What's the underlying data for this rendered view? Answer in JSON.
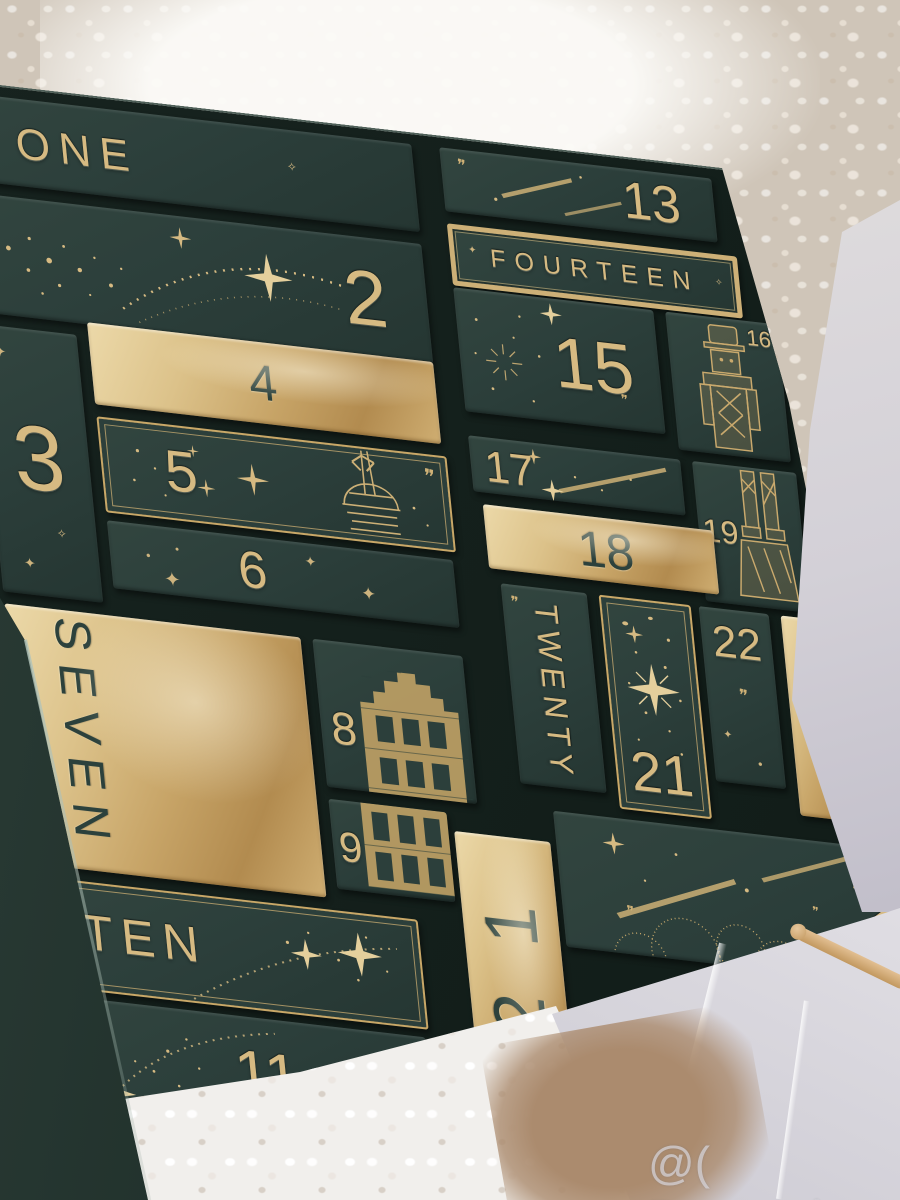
{
  "scene": {
    "description": "Dark green and gold beauty advent calendar with 24 numbered drawer boxes, photographed at an angle on cream boucle fabric",
    "watermark": "@( Bazos.sk"
  },
  "palette": {
    "box_dark": "#2c3f3b",
    "tray_dark": "#14201c",
    "gold_foil": "#d6ba82",
    "gold_bright": "#ecd9a9",
    "ink_on_gold": "#2c413c",
    "fabric_beige": "#cfc5b8",
    "fabric_white": "#f1efec",
    "curtain_grey": "#d3d0d7",
    "fur_tan": "#ab8b6e",
    "wood": "#d2a878"
  },
  "calendar": {
    "boxes": [
      {
        "num": 1,
        "label": "ONE",
        "finish": "dark"
      },
      {
        "num": 2,
        "label": "2",
        "finish": "dark"
      },
      {
        "num": 3,
        "label": "3",
        "finish": "dark"
      },
      {
        "num": 4,
        "label": "4",
        "finish": "gold"
      },
      {
        "num": 5,
        "label": "5",
        "finish": "dark-gold-frame"
      },
      {
        "num": 6,
        "label": "6",
        "finish": "dark"
      },
      {
        "num": 7,
        "label": "SEVEN",
        "finish": "gold"
      },
      {
        "num": 8,
        "label": "8",
        "finish": "dark"
      },
      {
        "num": 9,
        "label": "9",
        "finish": "dark"
      },
      {
        "num": 10,
        "label": "TEN",
        "finish": "dark-gold-frame"
      },
      {
        "num": 11,
        "label": "11",
        "finish": "dark"
      },
      {
        "num": 12,
        "label": "12",
        "digits": [
          "1",
          "2"
        ],
        "finish": "gold"
      },
      {
        "num": 13,
        "label": "13",
        "finish": "dark"
      },
      {
        "num": 14,
        "label": "FOURTEEN",
        "finish": "dark-gold-banner"
      },
      {
        "num": 15,
        "label": "15",
        "finish": "dark"
      },
      {
        "num": 16,
        "label": "16",
        "finish": "dark"
      },
      {
        "num": 17,
        "label": "17",
        "finish": "dark"
      },
      {
        "num": 18,
        "label": "18",
        "finish": "gold"
      },
      {
        "num": 19,
        "label": "19",
        "finish": "dark"
      },
      {
        "num": 20,
        "label": "TWENTY",
        "finish": "dark"
      },
      {
        "num": 21,
        "label": "21",
        "finish": "dark-gold-frame"
      },
      {
        "num": 22,
        "label": "22",
        "finish": "dark"
      },
      {
        "num": 23,
        "label": "23",
        "finish": "gold"
      },
      {
        "num": 24,
        "label": "24",
        "finish": "dark"
      }
    ]
  }
}
